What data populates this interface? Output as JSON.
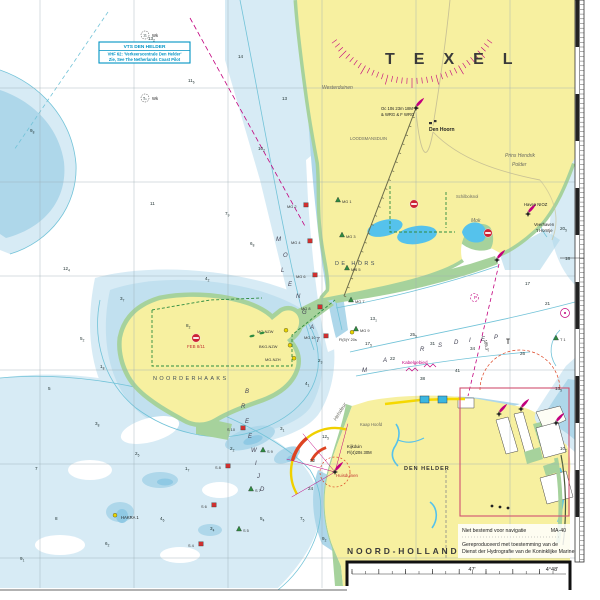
{
  "chart": {
    "vts": {
      "line1": "VTS DEN HELDER",
      "line2": "VHF 62: 'Verkeerscentrale Den Helder'",
      "line3": "Zie, See The Netherlands Coast Pilot"
    },
    "notes": {
      "l1": "Niet bestemd voor navigatie",
      "code": "MA-40",
      "l2": "Gereproduceerd met toestemming van de",
      "l3": "Dienst der Hydrografie van de Koninklijke Marine"
    },
    "margin": {
      "lon1": "47'",
      "lon2": "4°48'"
    },
    "colors": {
      "land": "#f7f0a0",
      "intertidal": "#a6d29c",
      "shallow_light": "#d7ebf5",
      "shallow_mid": "#aed7ea",
      "pool": "#8fc9e4",
      "lake": "#55c2ec",
      "contour": "#72c3d8",
      "magenta": "#c2007d",
      "vts_blue": "#0093c4",
      "buoy_red": "#d03030",
      "buoy_green": "#2e8b40",
      "buoy_yellow": "#e8d400",
      "prohibit_red": "#cc2233",
      "sector_yellow": "#f0d000",
      "sector_red": "#dd4422"
    },
    "labels": [
      {
        "t": "TEXEL",
        "x": 385,
        "y": 64,
        "cls": "big"
      },
      {
        "t": "Westerduinen",
        "x": 322,
        "y": 89,
        "cls": "terr"
      },
      {
        "t": "Den Hoorn",
        "x": 429,
        "y": 131,
        "cls": "town"
      },
      {
        "t": "LOODSMANSDUIN",
        "x": 350,
        "y": 140,
        "cls": "tiny-terr"
      },
      {
        "t": "Prins Hendrik",
        "x": 505,
        "y": 157,
        "cls": "terr"
      },
      {
        "t": "Polder",
        "x": 512,
        "y": 166,
        "cls": "terr"
      },
      {
        "t": "Schilbolsnol",
        "x": 456,
        "y": 198,
        "cls": "tiny-terr"
      },
      {
        "t": "Mok",
        "x": 471,
        "y": 222,
        "cls": "terr"
      },
      {
        "t": "Haven NIOZ",
        "x": 524,
        "y": 206,
        "cls": "tiny"
      },
      {
        "t": "Veerhaven",
        "x": 534,
        "y": 226,
        "cls": "tiny"
      },
      {
        "t": "'t Horntje",
        "x": 536,
        "y": 232,
        "cls": "tiny"
      },
      {
        "t": "DE HORS",
        "x": 335,
        "y": 265,
        "cls": "area"
      },
      {
        "t": "NOORDERHAAKS",
        "x": 153,
        "y": 380,
        "cls": "area"
      },
      {
        "t": "DEN HELDER",
        "x": 404,
        "y": 470,
        "cls": "town-sp"
      },
      {
        "t": "NOORD-HOLLAND",
        "x": 347,
        "y": 554,
        "cls": "region"
      },
      {
        "t": "Kaap Hoofd",
        "x": 360,
        "y": 426,
        "cls": "tiny-terr"
      },
      {
        "t": "Helsdeur",
        "x": 336,
        "y": 421,
        "cls": "terr",
        "rot": -58
      },
      {
        "t": "Huisduinen",
        "x": 336,
        "y": 477,
        "cls": "red-tiny"
      },
      {
        "t": "Kijkduin",
        "x": 347,
        "y": 448,
        "cls": "tiny"
      },
      {
        "t": "Fl(4)20s 30M",
        "x": 347,
        "y": 454,
        "cls": "tiny"
      },
      {
        "t": "Oc 10s 23m 18M",
        "x": 381,
        "y": 110,
        "cls": "tiny"
      },
      {
        "t": "& WRG & F WRG",
        "x": 381,
        "y": 116,
        "cls": "tiny"
      },
      {
        "t": "Kabelgebied",
        "x": 402,
        "y": 364,
        "cls": "mag-tiny"
      },
      {
        "t": "185.3°",
        "x": 484,
        "y": 340,
        "cls": "tiny",
        "rot": 80
      },
      {
        "t": "FEB 8/11",
        "x": 187,
        "y": 348,
        "cls": "red-tiny"
      },
      {
        "t": "Wk",
        "x": 152,
        "y": 37,
        "cls": "tiny"
      },
      {
        "t": "Wk",
        "x": 152,
        "y": 100,
        "cls": "tiny"
      },
      {
        "t": "P",
        "x": 474,
        "y": 299,
        "cls": "mag-tiny"
      },
      {
        "t": "Fl(3)G 10s",
        "x": 493,
        "y": 582,
        "cls": "tiny"
      },
      {
        "t": "Iso W 8s",
        "x": 493,
        "y": 589,
        "cls": "tiny"
      },
      {
        "t": "Nw Ba",
        "x": 383,
        "y": 583,
        "cls": "tiny"
      },
      {
        "t": "HAKRA 1",
        "x": 121,
        "y": 519,
        "cls": "tiny"
      },
      {
        "t": "M",
        "x": 362,
        "y": 372,
        "cls": "chan"
      },
      {
        "t": "A",
        "x": 383,
        "y": 362,
        "cls": "chan"
      },
      {
        "t": "R",
        "x": 420,
        "y": 351,
        "cls": "chan"
      },
      {
        "t": "S",
        "x": 438,
        "y": 347,
        "cls": "chan"
      },
      {
        "t": "D",
        "x": 454,
        "y": 344,
        "cls": "chan"
      },
      {
        "t": "I",
        "x": 469,
        "y": 342,
        "cls": "chan"
      },
      {
        "t": "E",
        "x": 481,
        "y": 341,
        "cls": "chan"
      },
      {
        "t": "P",
        "x": 494,
        "y": 339,
        "cls": "chan"
      },
      {
        "t": "M",
        "x": 276,
        "y": 241,
        "cls": "chan"
      },
      {
        "t": "O",
        "x": 283,
        "y": 257,
        "cls": "chan"
      },
      {
        "t": "L",
        "x": 281,
        "y": 272,
        "cls": "chan"
      },
      {
        "t": "E",
        "x": 288,
        "y": 286,
        "cls": "chan"
      },
      {
        "t": "N",
        "x": 296,
        "y": 298,
        "cls": "chan"
      },
      {
        "t": "G",
        "x": 302,
        "y": 314,
        "cls": "chan"
      },
      {
        "t": "A",
        "x": 310,
        "y": 329,
        "cls": "chan"
      },
      {
        "t": "T",
        "x": 316,
        "y": 342,
        "cls": "chan"
      },
      {
        "t": "B",
        "x": 245,
        "y": 393,
        "cls": "chan"
      },
      {
        "t": "R",
        "x": 241,
        "y": 408,
        "cls": "chan"
      },
      {
        "t": "E",
        "x": 245,
        "y": 423,
        "cls": "chan"
      },
      {
        "t": "E",
        "x": 248,
        "y": 438,
        "cls": "chan"
      },
      {
        "t": "W",
        "x": 251,
        "y": 452,
        "cls": "chan"
      },
      {
        "t": "I",
        "x": 255,
        "y": 465,
        "cls": "chan"
      },
      {
        "t": "J",
        "x": 257,
        "y": 478,
        "cls": "chan"
      },
      {
        "t": "D",
        "x": 260,
        "y": 491,
        "cls": "chan"
      }
    ],
    "soundings": [
      [
        148,
        40,
        "13",
        "2"
      ],
      [
        188,
        82,
        "11",
        "6"
      ],
      [
        282,
        100,
        "13",
        ""
      ],
      [
        238,
        58,
        "14",
        ""
      ],
      [
        258,
        150,
        "10",
        "2"
      ],
      [
        150,
        205,
        "11",
        ""
      ],
      [
        225,
        215,
        "7",
        "9"
      ],
      [
        30,
        132,
        "9",
        "8"
      ],
      [
        63,
        270,
        "12",
        "4"
      ],
      [
        186,
        327,
        "8",
        "2"
      ],
      [
        80,
        340,
        "5",
        "2"
      ],
      [
        120,
        300,
        "3",
        "7"
      ],
      [
        205,
        280,
        "4",
        "2"
      ],
      [
        250,
        245,
        "6",
        "8"
      ],
      [
        318,
        362,
        "2",
        "3"
      ],
      [
        100,
        368,
        "1",
        "8"
      ],
      [
        305,
        385,
        "4",
        "1"
      ],
      [
        48,
        390,
        "5",
        ""
      ],
      [
        95,
        425,
        "3",
        "8"
      ],
      [
        135,
        455,
        "2",
        "5"
      ],
      [
        185,
        470,
        "1",
        "7"
      ],
      [
        230,
        450,
        "2",
        "2"
      ],
      [
        280,
        430,
        "3",
        "1"
      ],
      [
        35,
        470,
        "7",
        ""
      ],
      [
        55,
        520,
        "8",
        ""
      ],
      [
        105,
        545,
        "6",
        "2"
      ],
      [
        160,
        520,
        "4",
        "6"
      ],
      [
        210,
        530,
        "3",
        "4"
      ],
      [
        260,
        520,
        "5",
        "4"
      ],
      [
        300,
        520,
        "7",
        "5"
      ],
      [
        322,
        540,
        "9",
        "2"
      ],
      [
        20,
        560,
        "9",
        "1"
      ],
      [
        365,
        345,
        "17",
        "5"
      ],
      [
        390,
        360,
        "22",
        ""
      ],
      [
        410,
        336,
        "25",
        "5"
      ],
      [
        430,
        345,
        "31",
        ""
      ],
      [
        470,
        350,
        "34",
        ""
      ],
      [
        520,
        355,
        "26",
        ""
      ],
      [
        545,
        305,
        "21",
        ""
      ],
      [
        560,
        230,
        "20",
        "5"
      ],
      [
        565,
        260,
        "18",
        ""
      ],
      [
        525,
        285,
        "17",
        ""
      ],
      [
        310,
        462,
        "32",
        ""
      ],
      [
        308,
        490,
        "24",
        ""
      ],
      [
        322,
        438,
        "12",
        "5"
      ],
      [
        420,
        380,
        "38",
        ""
      ],
      [
        455,
        372,
        "41",
        ""
      ],
      [
        370,
        320,
        "13",
        "1"
      ],
      [
        555,
        390,
        "13",
        "5"
      ],
      [
        560,
        450,
        "10",
        "2"
      ]
    ],
    "buoys": [
      {
        "x": 306,
        "y": 207,
        "s": "can",
        "c": "#d03030",
        "l": "MG 2",
        "lx": -19,
        "ly": 1
      },
      {
        "x": 310,
        "y": 243,
        "s": "can",
        "c": "#d03030",
        "l": "MG 4",
        "lx": -19,
        "ly": 1
      },
      {
        "x": 315,
        "y": 277,
        "s": "can",
        "c": "#d03030",
        "l": "MG 6",
        "lx": -19,
        "ly": 1
      },
      {
        "x": 320,
        "y": 309,
        "s": "can",
        "c": "#d03030",
        "l": "MG 8",
        "lx": -19,
        "ly": 1
      },
      {
        "x": 326,
        "y": 338,
        "s": "can",
        "c": "#d03030",
        "l": "MG 10",
        "lx": -22,
        "ly": 1
      },
      {
        "x": 338,
        "y": 202,
        "s": "cone",
        "c": "#2e8b40",
        "l": "MG 1",
        "lx": 4,
        "ly": 1
      },
      {
        "x": 342,
        "y": 237,
        "s": "cone",
        "c": "#2e8b40",
        "l": "MG 3",
        "lx": 4,
        "ly": 1
      },
      {
        "x": 347,
        "y": 270,
        "s": "cone",
        "c": "#2e8b40",
        "l": "MG 5",
        "lx": 4,
        "ly": 1
      },
      {
        "x": 351,
        "y": 302,
        "s": "cone",
        "c": "#2e8b40",
        "l": "MG 7",
        "lx": 4,
        "ly": 1
      },
      {
        "x": 356,
        "y": 331,
        "s": "cone",
        "c": "#2e8b40",
        "l": "MG 9",
        "lx": 4,
        "ly": 1
      },
      {
        "x": 286,
        "y": 332,
        "s": "sph",
        "c": "#e8d400",
        "l": "MG-NZW",
        "lx": -29,
        "ly": 1
      },
      {
        "x": 290,
        "y": 347,
        "s": "sph",
        "c": "#e8d400",
        "l": "BKG-NZW",
        "lx": -31,
        "ly": 1
      },
      {
        "x": 294,
        "y": 360,
        "s": "sph",
        "c": "#e8d400",
        "l": "MG-NZH",
        "lx": -29,
        "ly": 1
      },
      {
        "x": 243,
        "y": 430,
        "s": "can",
        "c": "#d03030",
        "l": "S 10",
        "lx": -16,
        "ly": 1
      },
      {
        "x": 228,
        "y": 468,
        "s": "can",
        "c": "#d03030",
        "l": "S 8",
        "lx": -13,
        "ly": 1
      },
      {
        "x": 214,
        "y": 507,
        "s": "can",
        "c": "#d03030",
        "l": "S 6",
        "lx": -13,
        "ly": 1
      },
      {
        "x": 201,
        "y": 546,
        "s": "can",
        "c": "#d03030",
        "l": "S 4",
        "lx": -13,
        "ly": 1
      },
      {
        "x": 263,
        "y": 452,
        "s": "cone",
        "c": "#2e8b40",
        "l": "S 9",
        "lx": 4,
        "ly": 1
      },
      {
        "x": 251,
        "y": 491,
        "s": "cone",
        "c": "#2e8b40",
        "l": "S 7",
        "lx": 4,
        "ly": 1
      },
      {
        "x": 239,
        "y": 531,
        "s": "cone",
        "c": "#2e8b40",
        "l": "S 5",
        "lx": 4,
        "ly": 1
      },
      {
        "x": 556,
        "y": 340,
        "s": "cone",
        "c": "#2e8b40",
        "l": "T 1",
        "lx": 4,
        "ly": 1
      },
      {
        "x": 352,
        "y": 334,
        "s": "sph",
        "c": "#e8d400",
        "l": "Fl(5)Y 20s",
        "lx": -13,
        "ly": 7
      },
      {
        "x": 115,
        "y": 517,
        "s": "sph",
        "c": "#e8d400",
        "l": "",
        "lx": 0,
        "ly": 0
      },
      {
        "x": 508,
        "y": 344,
        "s": "bcn",
        "c": "#222",
        "l": "",
        "lx": 0,
        "ly": 0
      },
      {
        "x": 356,
        "y": 587,
        "s": "can",
        "c": "#d03030",
        "l": "",
        "lx": 0,
        "ly": 0
      },
      {
        "x": 378,
        "y": 587,
        "s": "cone",
        "c": "#2e8b40",
        "l": "",
        "lx": 0,
        "ly": 0
      },
      {
        "x": 422,
        "y": 587,
        "s": "sph",
        "c": "#e8d400",
        "l": "",
        "lx": 0,
        "ly": 0
      },
      {
        "x": 540,
        "y": 587,
        "s": "bcn",
        "c": "#222",
        "l": "",
        "lx": 0,
        "ly": 0
      }
    ],
    "lights": [
      {
        "x": 416,
        "y": 108
      },
      {
        "x": 497,
        "y": 260
      },
      {
        "x": 528,
        "y": 214
      },
      {
        "x": 335,
        "y": 472
      },
      {
        "x": 499,
        "y": 414
      },
      {
        "x": 521,
        "y": 409
      },
      {
        "x": 556,
        "y": 423
      },
      {
        "x": 488,
        "y": 585
      }
    ],
    "wrecks": [
      {
        "x": 145,
        "y": 35,
        "t": "11"
      },
      {
        "x": 145,
        "y": 98,
        "t": "5₈"
      }
    ],
    "prohibs": [
      {
        "x": 414,
        "y": 204
      },
      {
        "x": 488,
        "y": 233
      },
      {
        "x": 196,
        "y": 338
      }
    ],
    "seals": [
      [
        252,
        336
      ],
      [
        262,
        333
      ]
    ]
  }
}
